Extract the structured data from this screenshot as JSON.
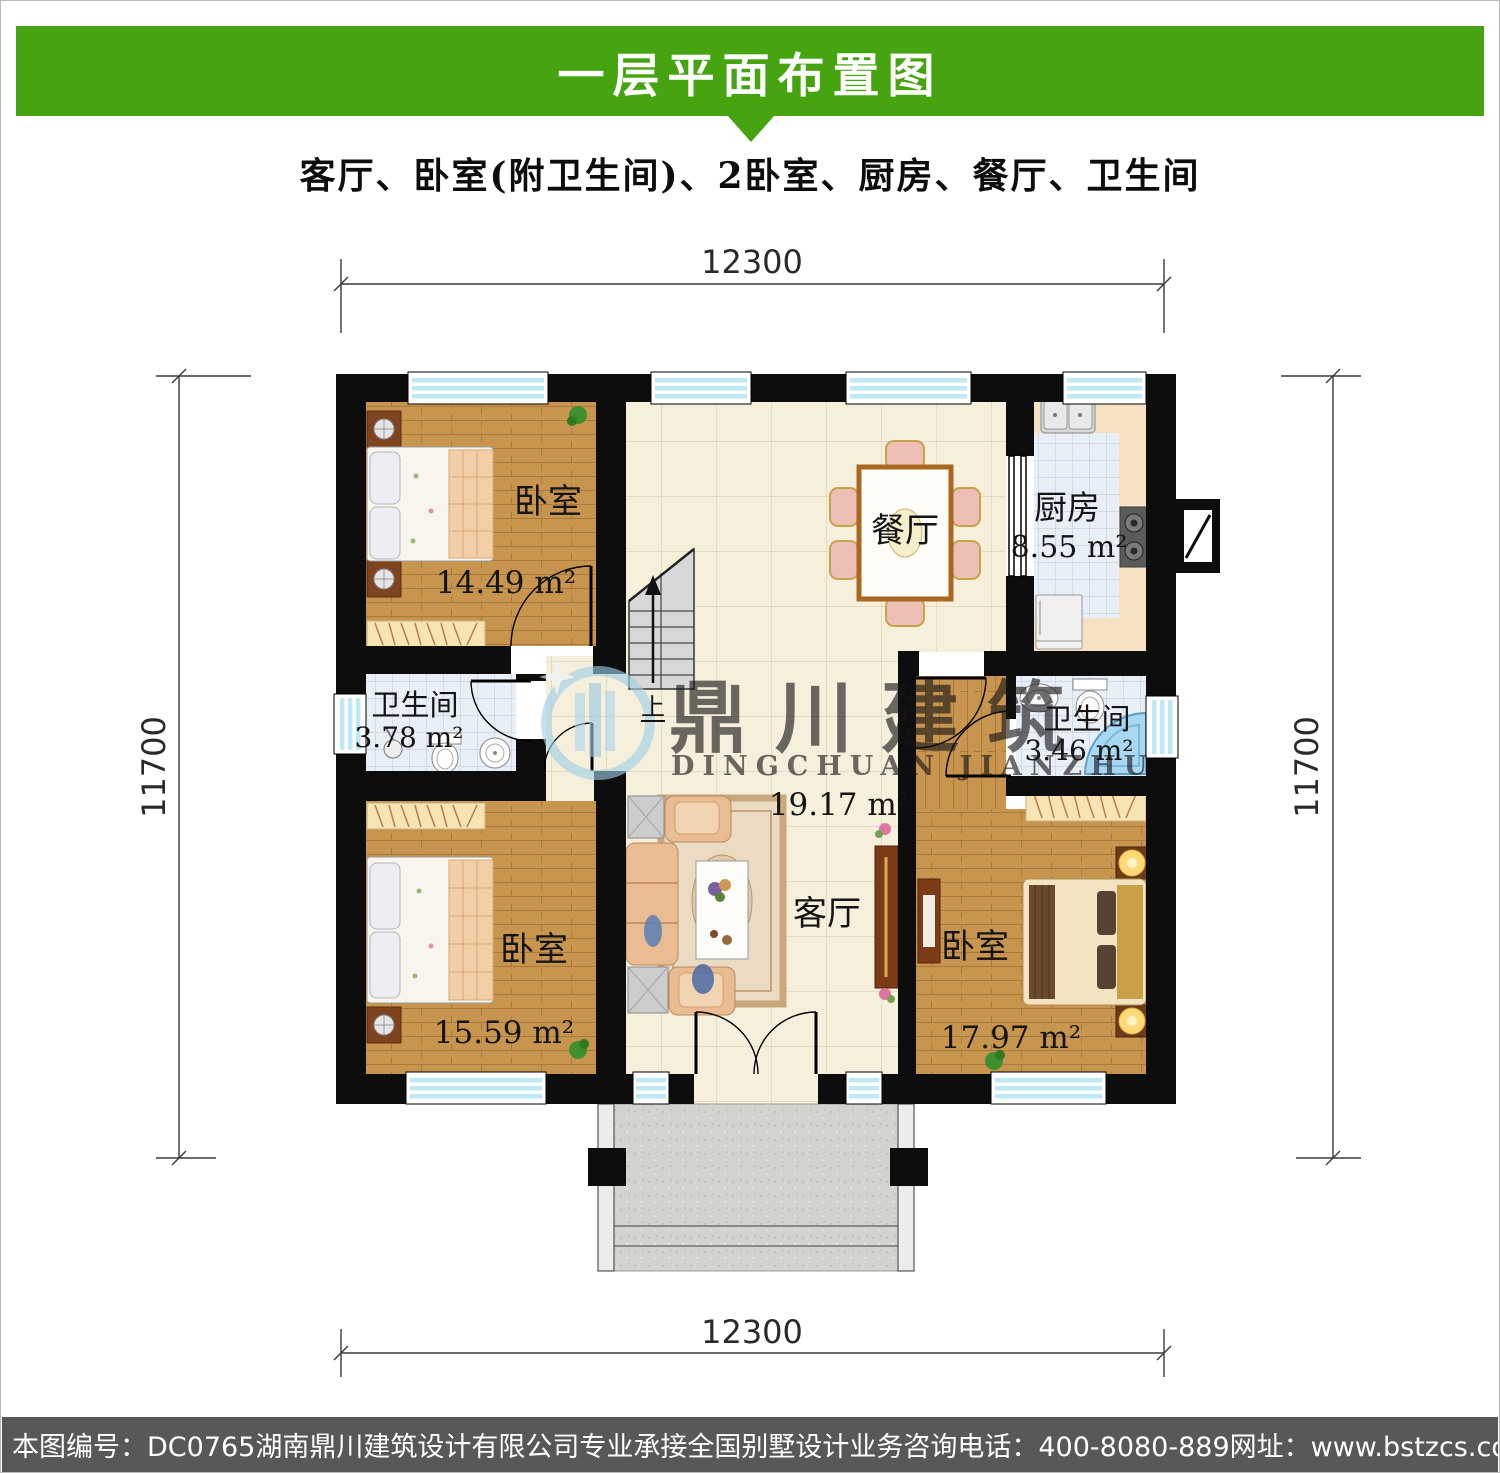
{
  "header": {
    "title": "一层平面布置图"
  },
  "subtitle": "客厅、卧室(附卫生间)、2卧室、厨房、餐厅、卫生间",
  "dimensions": {
    "top": "12300",
    "bottom": "12300",
    "left": "11700",
    "right": "11700"
  },
  "rooms": {
    "bedroom_tl": {
      "label": "卧室",
      "area": "14.49 m²"
    },
    "bedroom_bl": {
      "label": "卧室",
      "area": "15.59 m²"
    },
    "bedroom_br": {
      "label": "卧室",
      "area": "17.97 m²"
    },
    "living": {
      "label": "客厅",
      "area": "19.17 m²"
    },
    "dining": {
      "label": "餐厅"
    },
    "kitchen": {
      "label": "厨房",
      "area": "8.55 m²"
    },
    "bath_left": {
      "label": "卫生间",
      "area": "3.78 m²"
    },
    "bath_right": {
      "label": "卫生间",
      "area": "3.46 m²"
    }
  },
  "stairs": {
    "direction_label": "上"
  },
  "watermark": {
    "name_zh": "鼎川建筑",
    "name_en": "DINGCHUAN JIANZHU"
  },
  "footer": {
    "drawing_number": "本图编号：DC0765",
    "company": "湖南鼎川建筑设计有限公司专业承接全国别墅设计业务",
    "phone": "咨询电话：400-8080-889",
    "website": "网址：www.bstzcs.com"
  },
  "colors": {
    "header_green": "#46a410",
    "footer_gray": "#58585a",
    "wall_black": "#0d0d0d",
    "window_cyan": "#bfe9f2",
    "wood_floor": "#c8954f",
    "hall_tile": "#f5efdb",
    "bath_tile": "#e9eff6",
    "kitchen_counter": "#f6e2c2"
  }
}
